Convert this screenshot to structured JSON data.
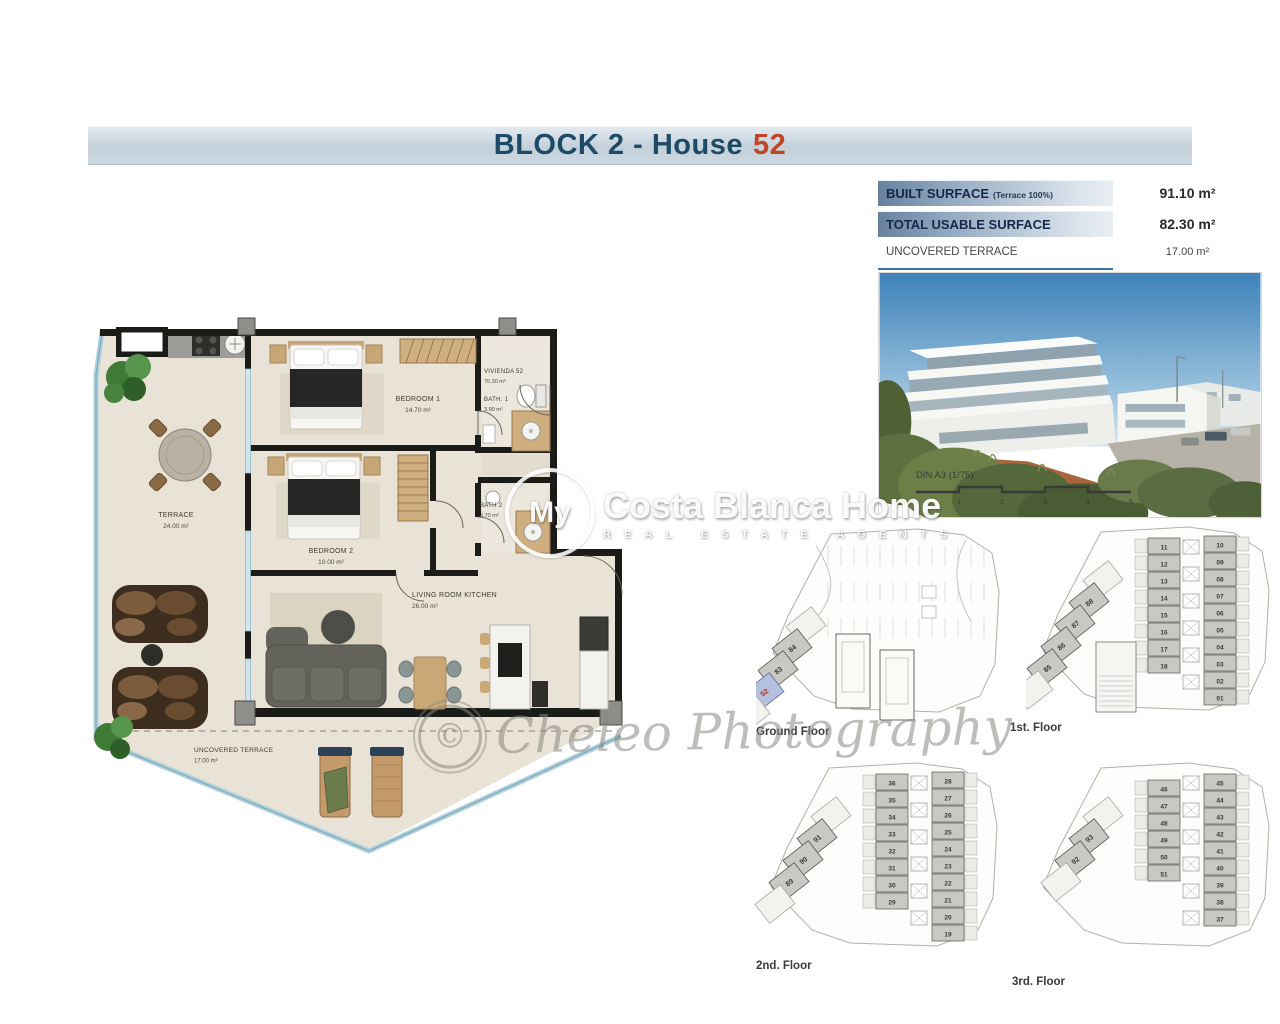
{
  "title": {
    "prefix": "BLOCK 2 - House",
    "number": "52"
  },
  "surface_table": {
    "rows": [
      {
        "label": "BUILT SURFACE",
        "sublabel": "(Terrace 100%)",
        "value": "91.10 m²",
        "bar": true
      },
      {
        "label": "TOTAL USABLE SURFACE",
        "sublabel": "",
        "value": "82.30 m²",
        "bar": true
      },
      {
        "label": "UNCOVERED TERRACE",
        "sublabel": "",
        "value": "17.00 m²",
        "bar": false
      }
    ]
  },
  "scale_bar": {
    "label": "DIN A3 (1/75)",
    "ticks": [
      "0",
      "1",
      "2",
      "3",
      "4",
      "5"
    ]
  },
  "watermarks": {
    "brand_prefix": "My",
    "brand_rest": "Costa Blanca Home",
    "brand_sub": "REAL ESTATE AGENTS",
    "credit_symbol": "©",
    "credit_text": "Cheleo Photography"
  },
  "main_plan": {
    "rooms": [
      {
        "name": "TERRACE",
        "area": "24.00 m²",
        "x": 88,
        "y": 202,
        "anchor": "middle",
        "size": 7
      },
      {
        "name": "BEDROOM 1",
        "area": "14.70 m²",
        "x": 330,
        "y": 86,
        "anchor": "middle",
        "size": 7
      },
      {
        "name": "VIVIENDA 52",
        "area": "70.30 m²",
        "x": 396,
        "y": 58,
        "anchor": "start",
        "size": 6
      },
      {
        "name": "BATH. 1",
        "area": "3.90 m²",
        "x": 396,
        "y": 86,
        "anchor": "start",
        "size": 6
      },
      {
        "name": "BEDROOM 2",
        "area": "10.00 m²",
        "x": 243,
        "y": 238,
        "anchor": "middle",
        "size": 7
      },
      {
        "name": "BATH 2",
        "area": "3.70 m²",
        "x": 392,
        "y": 192,
        "anchor": "start",
        "size": 6
      },
      {
        "name": "LIVING ROOM KITCHEN",
        "area": "26.00 m²",
        "x": 324,
        "y": 282,
        "anchor": "start",
        "size": 7
      },
      {
        "name": "UNCOVERED TERRACE",
        "area": "17.00 m²",
        "x": 106,
        "y": 437,
        "anchor": "start",
        "size": 6.5
      }
    ]
  },
  "floors": [
    {
      "name": "Ground Floor",
      "layout": "parking",
      "diagonal_units": [
        {
          "n": "84"
        },
        {
          "n": "83"
        },
        {
          "n": "52",
          "highlight": true
        }
      ]
    },
    {
      "name": "1st. Floor",
      "layout": "tower",
      "pool": true,
      "left_units": [
        "11",
        "12",
        "13",
        "14",
        "15",
        "16",
        "17",
        "18"
      ],
      "right_units": [
        "10",
        "09",
        "08",
        "07",
        "06",
        "05",
        "04",
        "03",
        "02",
        "01"
      ],
      "diagonal_units": [
        {
          "n": "88"
        },
        {
          "n": "87"
        },
        {
          "n": "86"
        },
        {
          "n": "85"
        }
      ]
    },
    {
      "name": "2nd. Floor",
      "layout": "tower",
      "pool": false,
      "left_units": [
        "36",
        "35",
        "34",
        "33",
        "32",
        "31",
        "30",
        "29"
      ],
      "right_units": [
        "28",
        "27",
        "26",
        "25",
        "24",
        "23",
        "22",
        "21",
        "20",
        "19"
      ],
      "diagonal_units": [
        {
          "n": "91"
        },
        {
          "n": "90"
        },
        {
          "n": "89"
        }
      ]
    },
    {
      "name": "3rd. Floor",
      "layout": "tower",
      "pool": false,
      "left_units": [
        "46",
        "47",
        "48",
        "49",
        "50",
        "51"
      ],
      "right_units": [
        "45",
        "44",
        "43",
        "42",
        "41",
        "40",
        "39",
        "38",
        "37"
      ],
      "diagonal_units": [
        {
          "n": "93"
        },
        {
          "n": "92"
        }
      ]
    }
  ]
}
